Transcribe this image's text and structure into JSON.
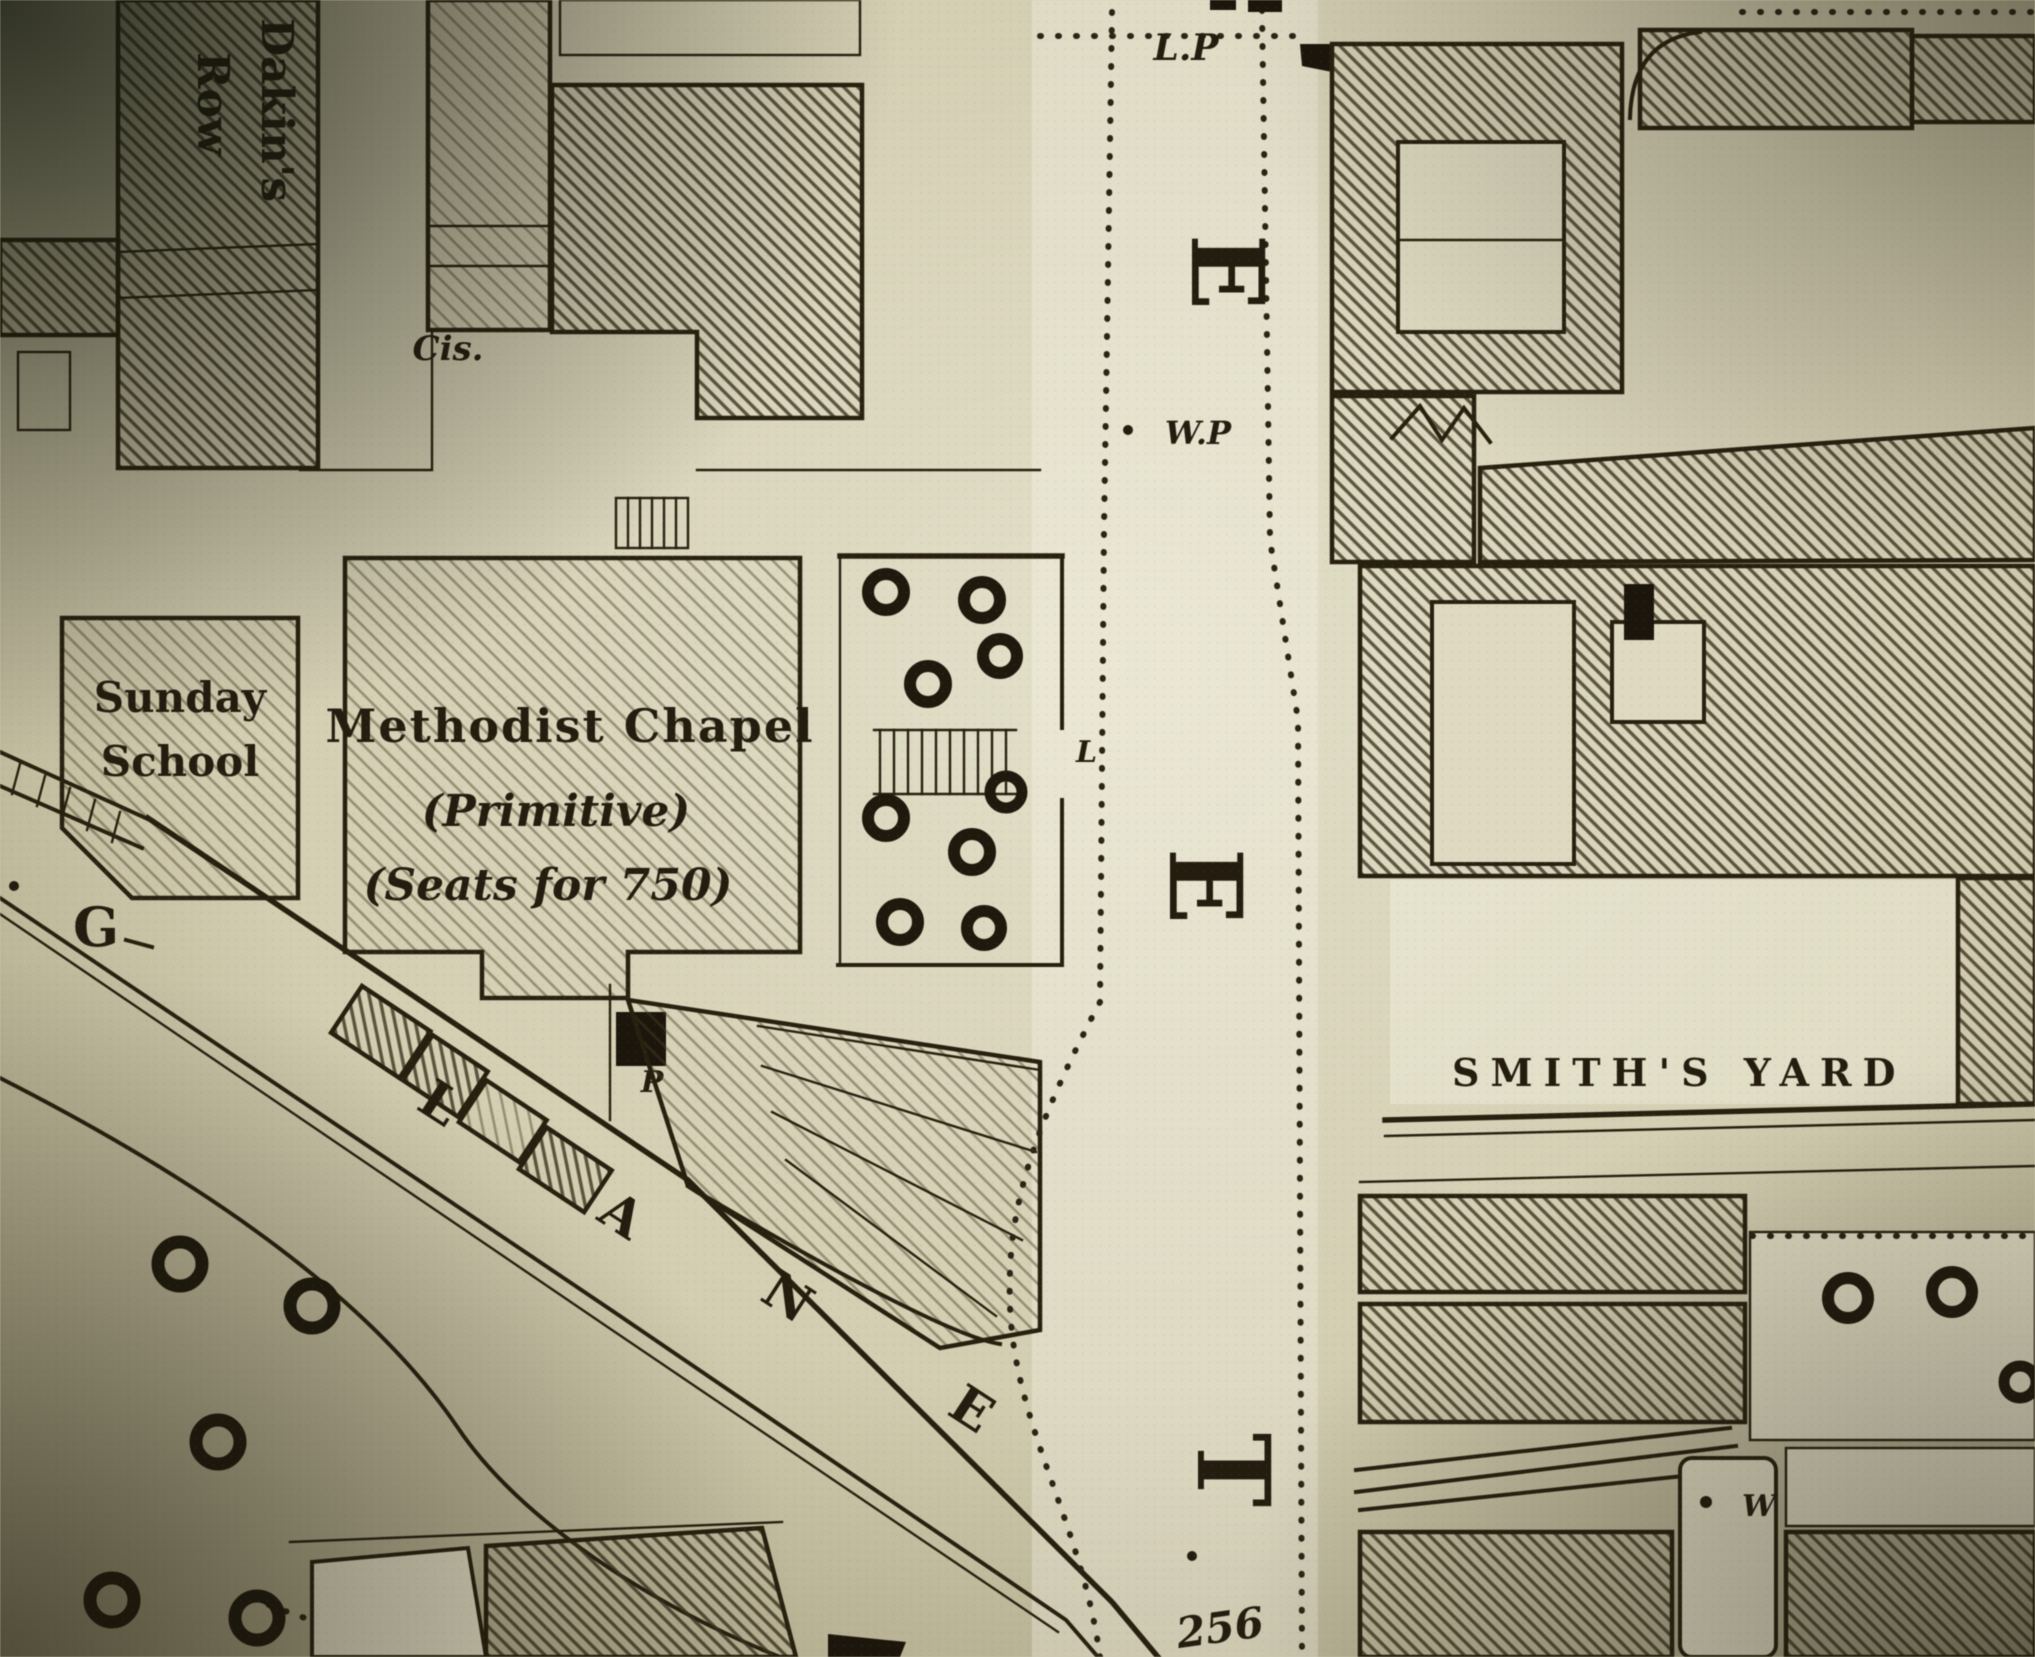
{
  "meta": {
    "kind": "photograph of historic Ordnance-Survey-style town plan"
  },
  "labels": {
    "dakins_row": {
      "line1": "Dakin's",
      "line2": "Row"
    },
    "cistern": "Cis.",
    "sunday_school": {
      "line1": "Sunday",
      "line2": "School"
    },
    "chapel": {
      "line1": "Methodist Chapel",
      "line2": "(Primitive)",
      "line3": "(Seats for 750)"
    },
    "lamp_post": "L.P",
    "water_pump": "W.P",
    "street_letters": [
      "E",
      "E",
      "T"
    ],
    "parcel_number": "256",
    "smiths_yard": "SMITH'S YARD",
    "lane_letters": [
      "G",
      "L",
      "A",
      "N",
      "E"
    ],
    "pump": "P",
    "well": "W",
    "forecourt_letter": "L"
  },
  "colors": {
    "paper": "#d3cdb1",
    "paper_bright": "#e3e0ca",
    "ink": "#241c0e",
    "hatch_stroke": "#3a2f1c",
    "corner_shadow": "#23210f"
  }
}
